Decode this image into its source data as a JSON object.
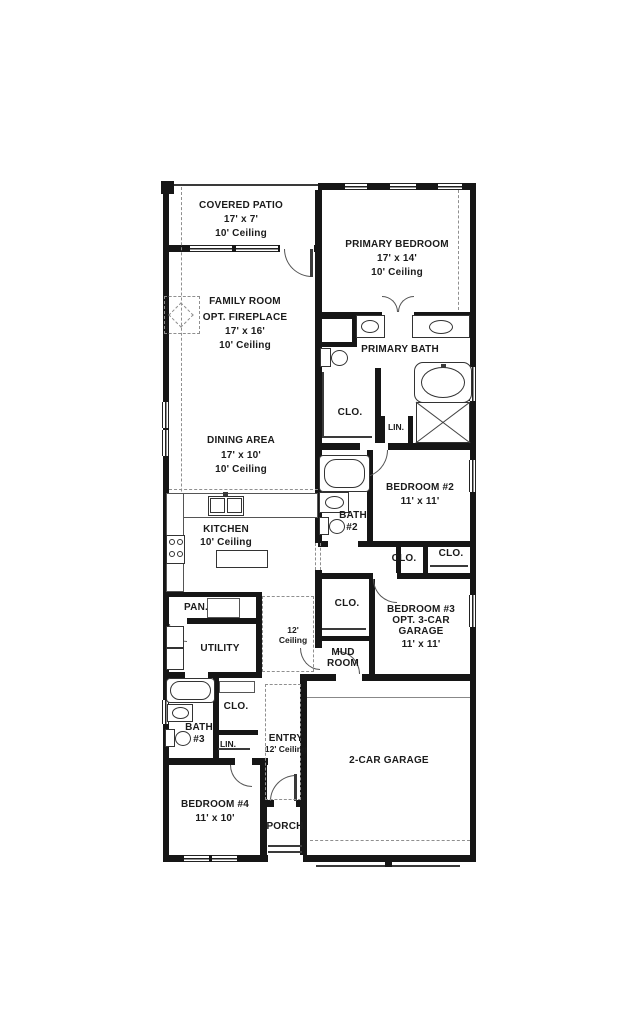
{
  "colors": {
    "wall": "#161616",
    "line": "#333333",
    "dashed": "#8f8f8f",
    "text": "#1b1b1b",
    "background": "#ffffff"
  },
  "plan": {
    "rooms": {
      "covered_patio": {
        "name": "COVERED PATIO",
        "dims": "17' x 7'",
        "ceiling": "10' Ceiling"
      },
      "primary_bedroom": {
        "name": "PRIMARY BEDROOM",
        "dims": "17' x 14'",
        "ceiling": "10' Ceiling"
      },
      "family_room": {
        "name": "FAMILY ROOM",
        "option": "OPT. FIREPLACE",
        "dims": "17' x 16'",
        "ceiling": "10' Ceiling"
      },
      "primary_bath": {
        "name": "PRIMARY BATH"
      },
      "primary_closet": {
        "name": "CLO."
      },
      "primary_linen": {
        "name": "LIN."
      },
      "dining_area": {
        "name": "DINING AREA",
        "dims": "17' x 10'",
        "ceiling": "10' Ceiling"
      },
      "bedroom_2": {
        "name": "BEDROOM #2",
        "dims": "11' x 11'"
      },
      "bath_2": {
        "name": "BATH",
        "number": "#2"
      },
      "kitchen": {
        "name": "KITCHEN",
        "ceiling": "10' Ceiling"
      },
      "closet_1": {
        "name": "CLO."
      },
      "closet_2": {
        "name": "CLO."
      },
      "pantry": {
        "name": "PAN."
      },
      "bedroom_3": {
        "name": "BEDROOM #3",
        "option_line1": "OPT. 3-CAR",
        "option_line2": "GARAGE",
        "dims": "11' x 11'"
      },
      "bedroom_3_closet": {
        "name": "CLO."
      },
      "utility": {
        "name": "UTILITY"
      },
      "hallway": {
        "ceiling_line1": "12'",
        "ceiling_line2": "Ceiling"
      },
      "mud_room": {
        "line1": "MUD",
        "line2": "ROOM"
      },
      "hall_closet": {
        "name": "CLO."
      },
      "bath_3": {
        "name": "BATH",
        "number": "#3"
      },
      "linen_2": {
        "name": "LIN."
      },
      "entry": {
        "name": "ENTRY",
        "ceiling": "12' Ceiling"
      },
      "bedroom_4": {
        "name": "BEDROOM #4",
        "dims": "11' x 10'"
      },
      "garage": {
        "name": "2-CAR GARAGE"
      },
      "porch": {
        "name": "PORCH"
      }
    }
  }
}
